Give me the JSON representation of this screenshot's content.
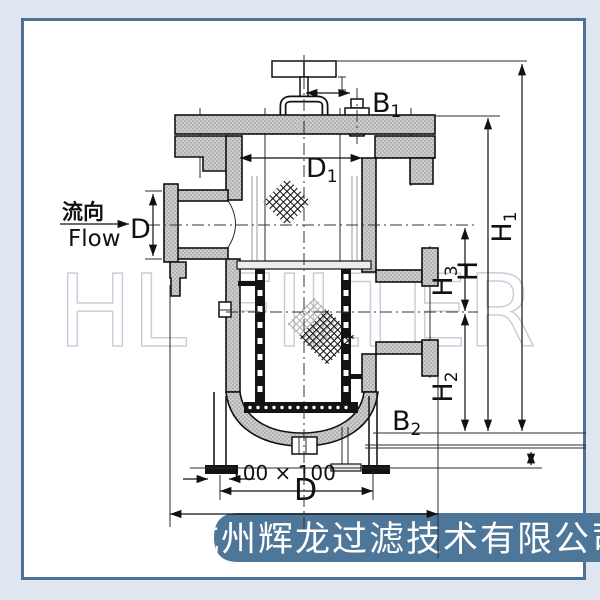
{
  "colors": {
    "page_bg": "#e0e6ef",
    "frame": "#4c7295",
    "panel": "#ffffff",
    "banner_bg": "#4d7699",
    "banner_text": "#ffffff",
    "drawing_line": "#111111",
    "stipple_fill": "#cdcdcd",
    "watermark": "#c9cfd9"
  },
  "watermark": {
    "text": "HL FILTER"
  },
  "flow": {
    "cn": "流向",
    "en": "Flow"
  },
  "dims": {
    "d_inlet": "D",
    "d1_base": "D",
    "d1_sub": "1",
    "b1_base": "B",
    "b1_sub": "1",
    "h1_base": "H",
    "h1_sub": "1",
    "h_base": "H",
    "h3_base": "H",
    "h3_sub": "3",
    "h2_base": "H",
    "h2_sub": "2",
    "b2_base": "B",
    "b2_sub": "2",
    "foot_pad": "100 × 100",
    "d_bottom": "D"
  },
  "banner": {
    "company": "杭州辉龙过滤技术有限公司"
  }
}
